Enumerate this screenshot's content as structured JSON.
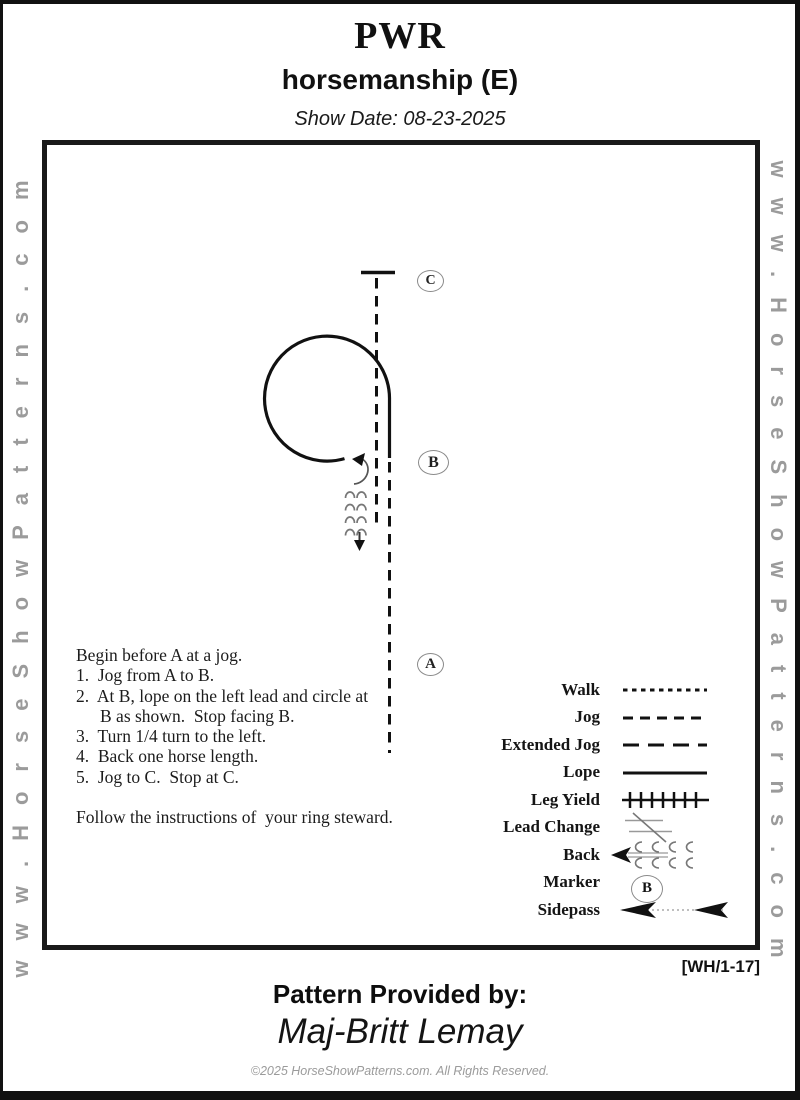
{
  "header": {
    "title": "PWR",
    "subtitle": "horsemanship (E)",
    "show_date": "Show Date: 08-23-2025"
  },
  "watermarks": {
    "left": "www.HorseShowPatterns.com",
    "right": "www.HorseShowPatterns.com"
  },
  "diagram": {
    "markers": [
      {
        "label": "C"
      },
      {
        "label": "B"
      },
      {
        "label": "A"
      }
    ]
  },
  "instructions": {
    "lines": [
      "Begin before A at a jog.",
      "1.  Jog from A to B.",
      "2.  At B, lope on the left lead and circle at",
      "B as shown.  Stop facing B.",
      "3.  Turn 1/4 turn to the left.",
      "4.  Back one horse length.",
      "5.  Jog to C.  Stop at C."
    ],
    "note": "Follow the instructions of  your ring steward."
  },
  "legend": {
    "items": [
      {
        "label": "Walk"
      },
      {
        "label": "Jog"
      },
      {
        "label": "Extended Jog"
      },
      {
        "label": "Lope"
      },
      {
        "label": "Leg Yield"
      },
      {
        "label": "Lead Change"
      },
      {
        "label": "Back"
      },
      {
        "label": "Marker",
        "marker_letter": "B"
      },
      {
        "label": "Sidepass"
      }
    ]
  },
  "footer": {
    "code": "[WH/1-17]",
    "provided_by_label": "Pattern Provided by:",
    "provided_by_name": "Maj-Britt Lemay",
    "copyright": "©2025 HorseShowPatterns.com. All Rights Reserved."
  }
}
